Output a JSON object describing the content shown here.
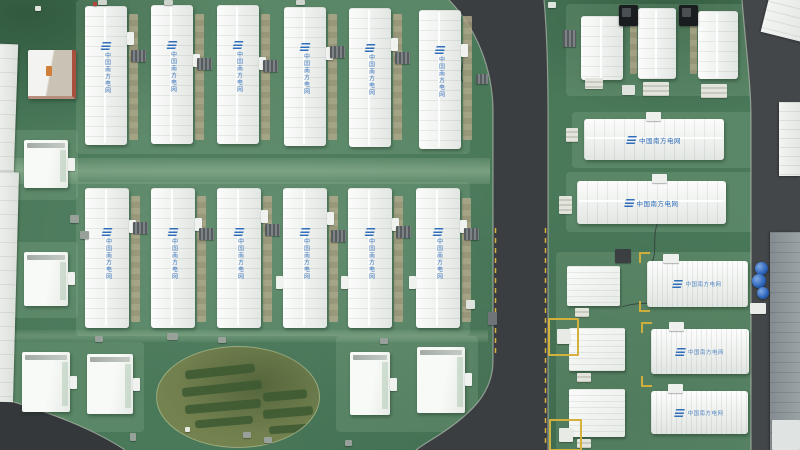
{
  "scene": {
    "name": "aerial-view-battery-energy-storage-station",
    "view": "top-down drone photo"
  },
  "brand": {
    "label": "中国南方电网",
    "icon": "csg-grid-logo-icon",
    "logo_color": "#2f6db9"
  },
  "inventory": {
    "left_yard_long_buildings_row1": 6,
    "left_yard_long_buildings_row2": 6,
    "right_horizontal_buildings": 2,
    "top_right_buildings": 3,
    "bottom_right_large_containers": 3,
    "bottom_right_small_containers": 3,
    "auxiliary_small_buildings": 6,
    "landscaped_oval_gardens": 1
  },
  "colors": {
    "ground": "#4a795a",
    "pad": "#6b9a74",
    "road": "#3a3e41",
    "road-right": "#43474a",
    "road-corner": "#34383a",
    "curb": "#c6cabf",
    "marking-yellow": "#d4b13c",
    "building-white": "#f3f5f2",
    "tan": "#b3a78a",
    "logo-blue": "#2f6db9",
    "hedge": "#3d5a32",
    "oval": "#717f4e",
    "oval-dark": "#55663c",
    "gray-roof": "#9aa2a6",
    "barrel-blue": "#2b62b8",
    "red-structure": "#a8503c"
  }
}
